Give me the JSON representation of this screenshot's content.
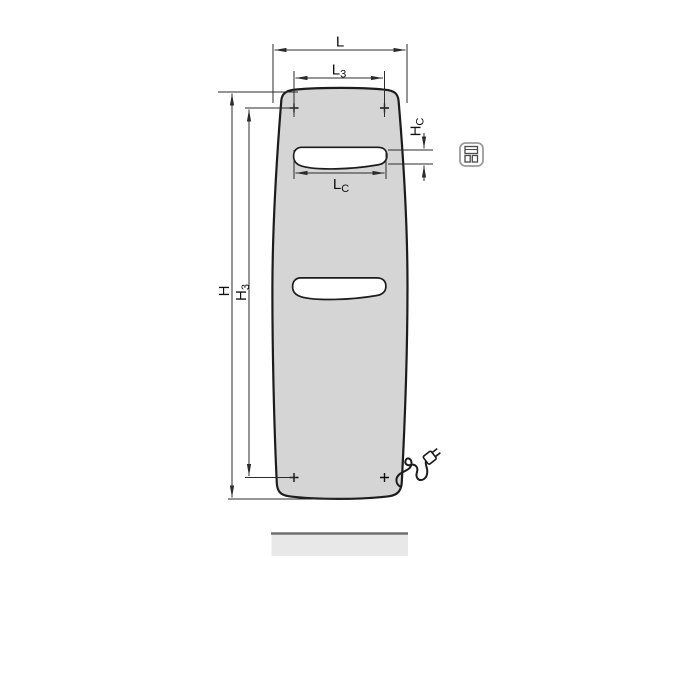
{
  "diagram": {
    "kind": "radiator-dimensional-drawing",
    "labels": {
      "L": {
        "main": "L",
        "sub": ""
      },
      "L3": {
        "main": "L",
        "sub": "3"
      },
      "LC": {
        "main": "L",
        "sub": "C"
      },
      "H": {
        "main": "H",
        "sub": ""
      },
      "H3": {
        "main": "H",
        "sub": "3"
      },
      "HC": {
        "main": "H",
        "sub": "C"
      }
    },
    "icons": {
      "connection": "electric-connection-icon"
    },
    "colors": {
      "panel_fill": "#d5d5d5",
      "outline": "#1c1c1c",
      "dimension": "#2b2b2b",
      "floor_fill": "#e8e8e8",
      "floor_edge": "#707070",
      "icon_border": "#9b9b9b",
      "icon_glyph": "#4a4a4a"
    }
  }
}
